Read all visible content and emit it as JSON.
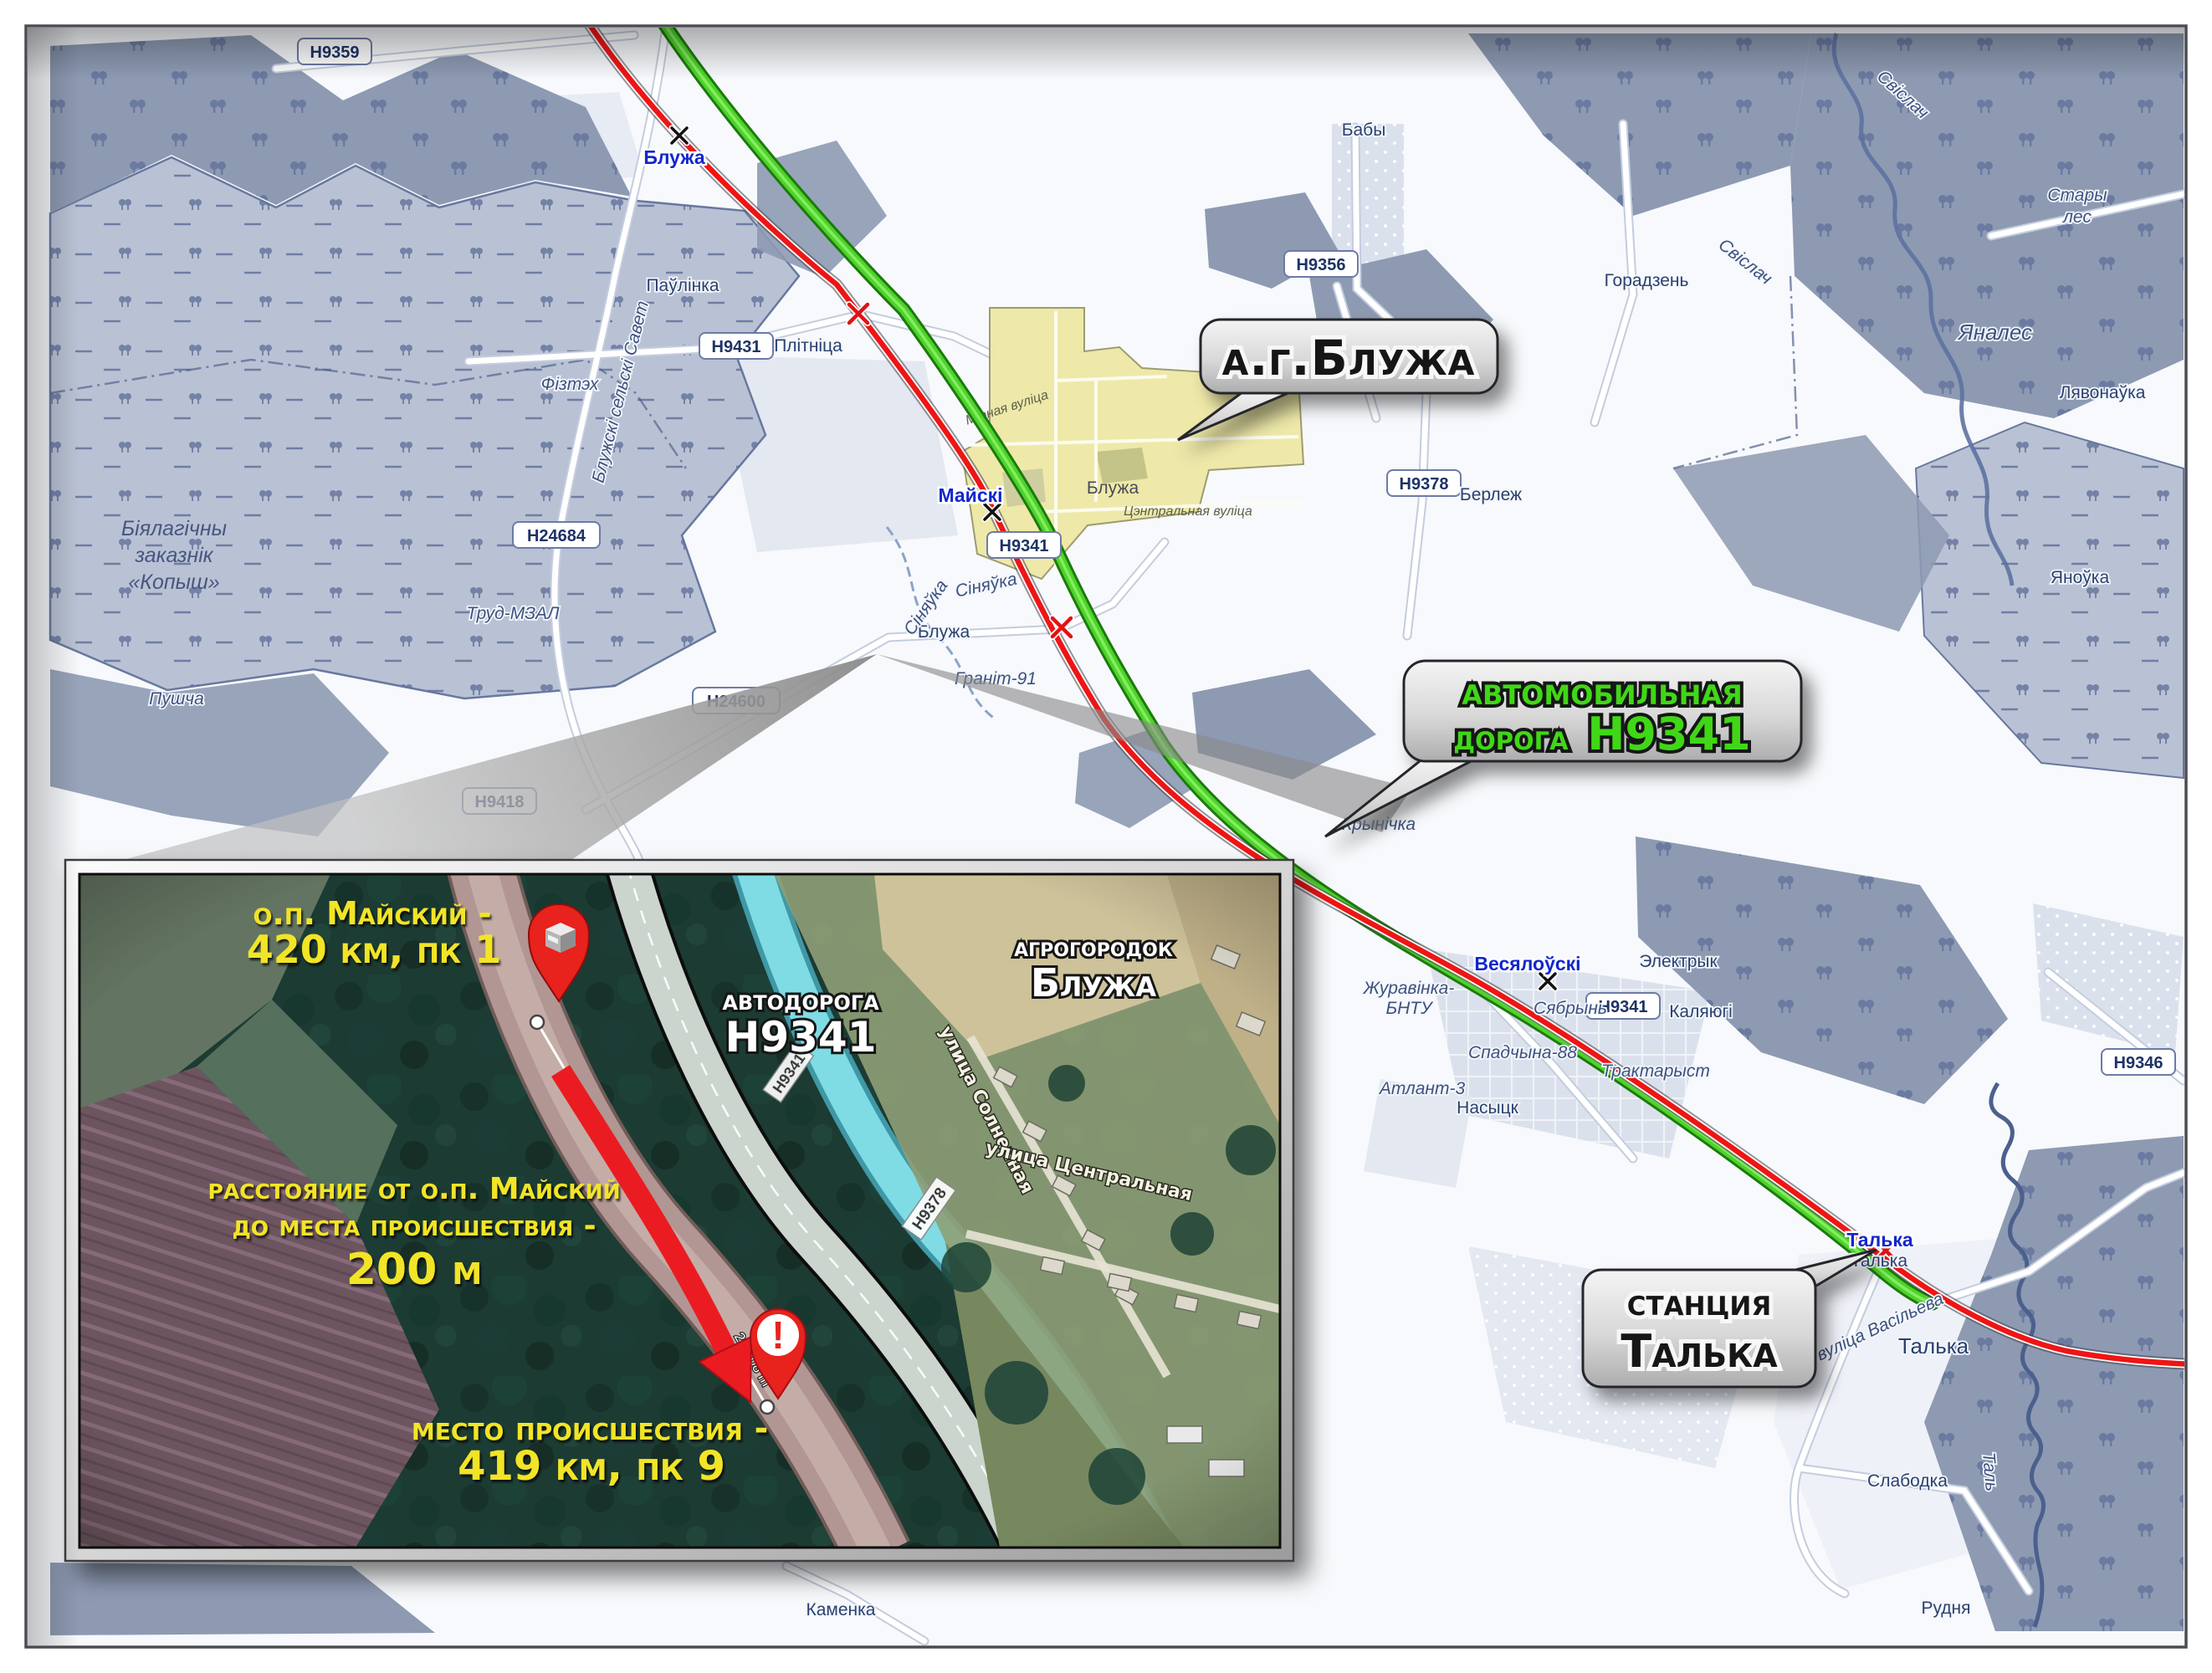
{
  "main_map": {
    "stations": {
      "bluzha": "Блужа",
      "maiski": "Майскі",
      "vesialouski": "Весялоўскі",
      "talka": "Талька"
    },
    "road_badges": {
      "h9359": "Н9359",
      "h9431": "Н9431",
      "h24684": "Н24684",
      "h24600": "Н24600",
      "h9418": "Н9418",
      "h9341": "Н9341",
      "h9356": "Н9356",
      "h9378": "Н9378",
      "h9346": "Н9346"
    },
    "places": {
      "paulinka": "Паўлінка",
      "plitnica": "Плітніца",
      "fiztekh": "Фізтэх",
      "trud_mzal": "Труд-МЗАЛ",
      "pushcha": "Пушча",
      "baby": "Бабы",
      "goradzen": "Горадзень",
      "berlezh": "Берлеж",
      "bluzha_village": "Блужа",
      "granit": "Граніт-91",
      "krynichka": "Крынічка",
      "lyavonauka": "Лявонаўка",
      "yanouka": "Яноўка",
      "yanales": "Яналес",
      "stary_les_1": "Стары",
      "stary_les_2": "лес",
      "elektryk": "Электрык",
      "kalyugi": "Каляюгі",
      "syabryn": "Сябрынь",
      "spadchyna": "Спадчына-88",
      "traktaryst": "Трактарыст",
      "nasytsk": "Насыцк",
      "zhuravinka_1": "Журавінка-",
      "zhuravinka_2": "БНТУ",
      "atlant": "Атлант-3",
      "talka_village": "Талька",
      "talka_small": "Талька",
      "slabodka": "Слабодка",
      "rudnya": "Рудня",
      "kamenka": "Каменка"
    },
    "rivers": {
      "svislach_1": "Свіслач",
      "svislach_2": "Свіслач",
      "sinyauka_1": "Сіняўка",
      "sinyauka_2": "Сіняўка",
      "tal": "Таль"
    },
    "streets": {
      "vasilyeva": "вуліца Васільева",
      "mirnaya": "Мірная вуліца",
      "tsentralnaya": "Цэнтральная вуліца"
    },
    "council": "Блужскі сельскі Савет",
    "reserve": {
      "line1": "Біялагічны",
      "line2": "заказнік",
      "line3": "«Копыш»"
    }
  },
  "callouts": {
    "bluzha": {
      "text": "а.г.Блужа"
    },
    "road": {
      "line1": "автомобильная",
      "line2a": "дорога ",
      "line2b": "Н9341",
      "text_color": "#3fd714"
    },
    "station_talka": {
      "line1": "станция",
      "line2": "Талька"
    }
  },
  "inset": {
    "op_maiski": {
      "line1": "о.п. Майский -",
      "line2": "420 км, пк 1"
    },
    "road_label": {
      "line1": "автодорога",
      "line2": "Н9341"
    },
    "agro_label": {
      "line1": "агрогородок",
      "line2": "Блужа"
    },
    "distance": {
      "line1": "расстояние от о.п. Майский",
      "line2": "до места происшествия -",
      "line3": "200 м"
    },
    "incident": {
      "line1": "место происшествия -",
      "line2": "419 км, пк 9"
    },
    "streets": {
      "diagonal": "улица Солнечная",
      "horizontal": "улица Центральная"
    },
    "badges": {
      "h9378": "Н9378",
      "h9341": "Н9341"
    },
    "measurement": "209.08 m",
    "colors": {
      "text_yellow": "#f2e426",
      "pin_red": "#e8211d"
    }
  },
  "legend_colors": {
    "railway_red": "#ee1515",
    "road_green": "#4ed32b",
    "forest": "#8d9ab2",
    "marsh": "#b9c2d4",
    "agro_yellow": "#eee9a7"
  }
}
